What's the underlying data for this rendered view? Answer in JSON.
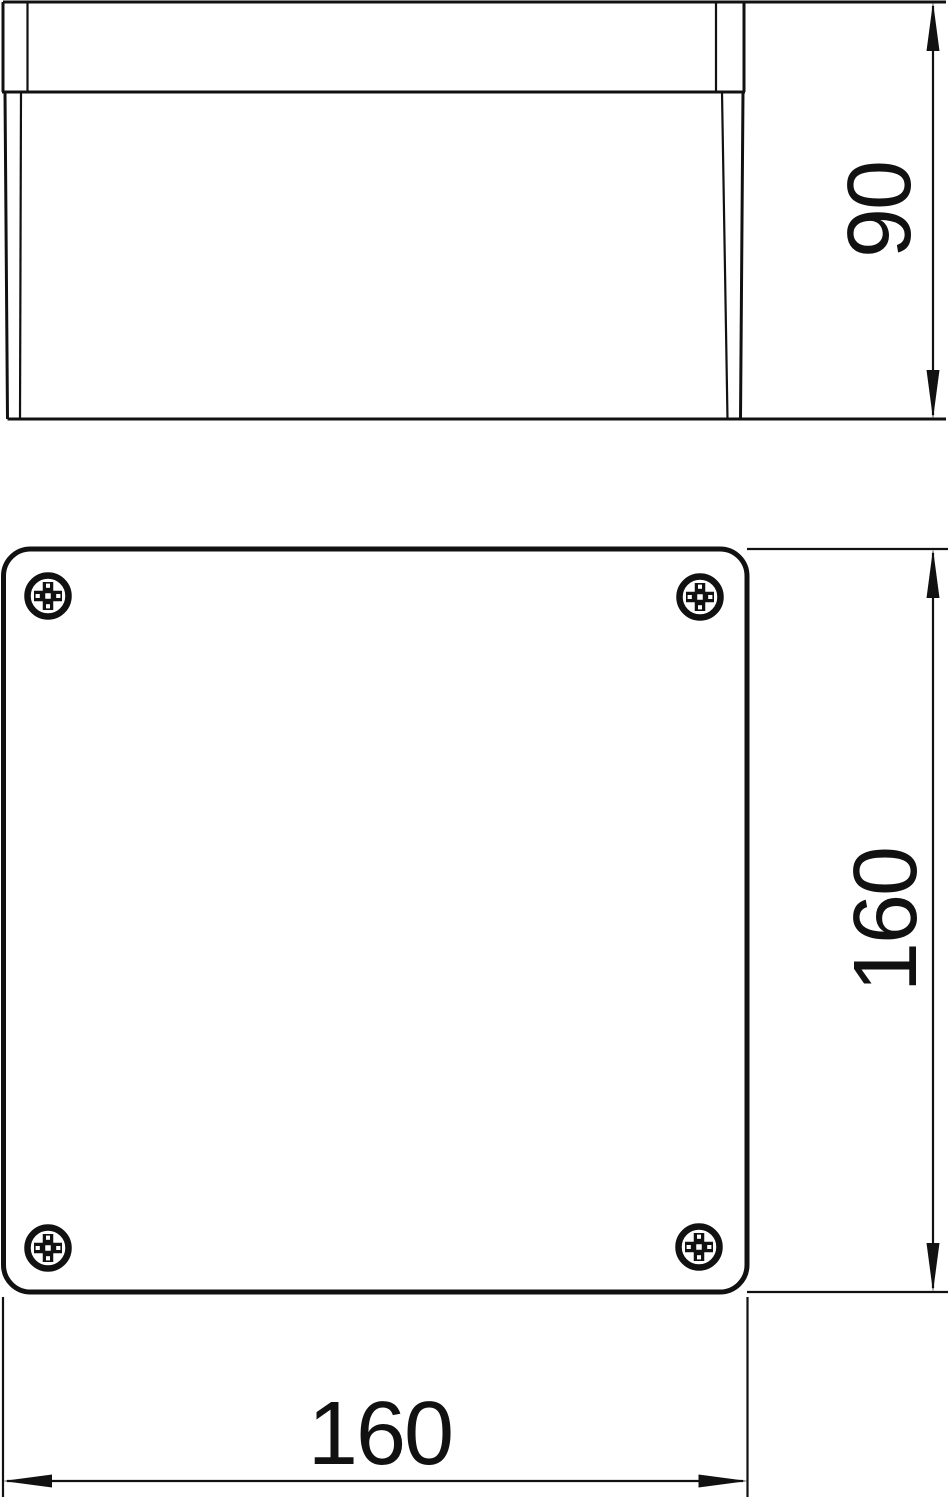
{
  "drawing": {
    "kind": "technical-dimension-drawing",
    "subject": "junction-box",
    "background_color": "#ffffff",
    "line_color": "#111111"
  },
  "views": [
    {
      "id": "side-elevation",
      "description": "side view of box with lid on top"
    },
    {
      "id": "plan-view",
      "description": "top view, rounded square lid with 4 corner screws"
    }
  ],
  "dims": [
    {
      "id": "height",
      "value": "90",
      "orientation": "vertical",
      "view": "side-elevation"
    },
    {
      "id": "depth",
      "value": "160",
      "orientation": "vertical",
      "view": "plan-view"
    },
    {
      "id": "width",
      "value": "160",
      "orientation": "horizontal",
      "view": "plan-view"
    }
  ],
  "screws": {
    "count": 4,
    "icon": "phillips-screw-icon"
  },
  "icons": {
    "screw": "phillips-screw-icon",
    "arrowhead": "dimension-arrowhead-icon"
  }
}
